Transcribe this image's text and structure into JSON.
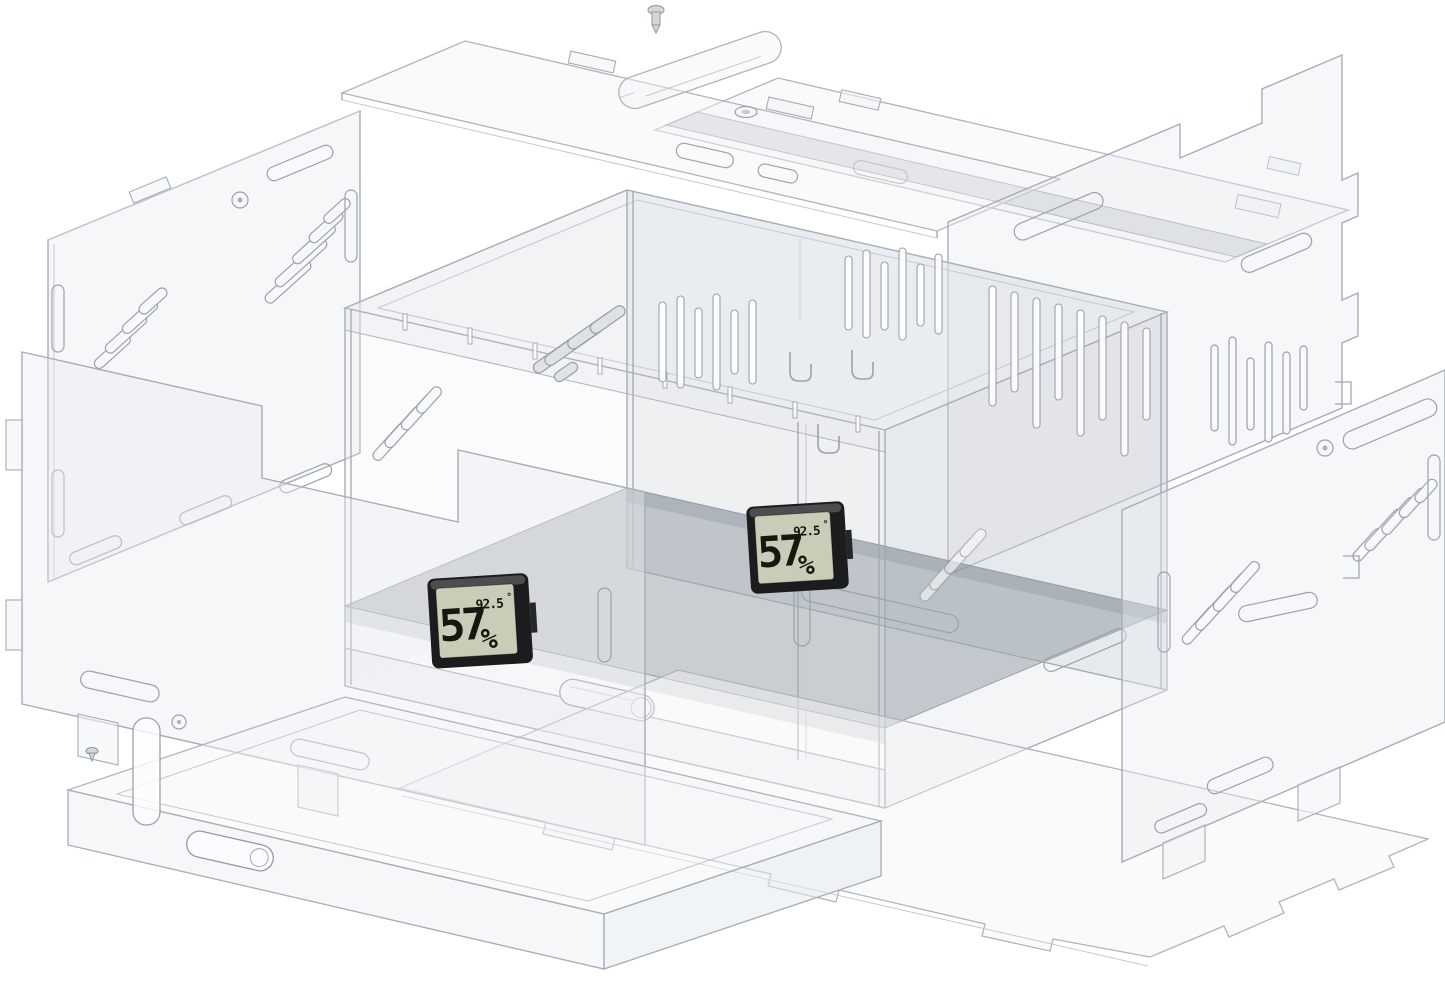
{
  "scene": {
    "background": "#ffffff",
    "acrylic_line_color": "#a6adb5",
    "panel_tint": "#e8ecf0",
    "floor_tint": "#8a96a2"
  },
  "hygrometers": {
    "front": {
      "humidity": "57",
      "humidity_unit": "%",
      "temperature": "92.5",
      "temperature_unit": "°",
      "lcd_color": "#c9cdb7",
      "frame_color": "#1b1c1e"
    },
    "back": {
      "humidity": "57",
      "humidity_unit": "%",
      "temperature": "92.5",
      "temperature_unit": "°",
      "lcd_color": "#c9cdb7",
      "frame_color": "#1b1c1e"
    }
  }
}
